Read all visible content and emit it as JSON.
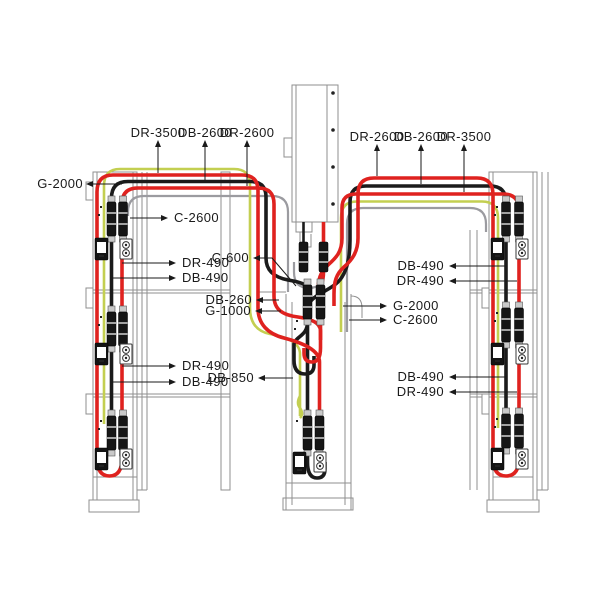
{
  "colors": {
    "red": "#df221f",
    "black": "#1b1b1b",
    "green": "#c3cf51",
    "gray": "#9b9ba0",
    "frame": "#8f8f8f",
    "leader": "#1a1a1a"
  },
  "labels": {
    "top_left": [
      "DR-3500",
      "DB-2600",
      "DR-2600"
    ],
    "top_right": [
      "DR-2600",
      "DB-2600",
      "DR-3500"
    ],
    "g2000_left": "G-2000",
    "c2600_left": "C-2600",
    "dr490_upper_left": "DR-490",
    "db490_upper_left": "DB-490",
    "dr490_lower_left": "DR-490",
    "db490_lower_left": "DB-490",
    "c600": "C-600",
    "db260": "DB-260",
    "g1000": "G-1000",
    "g2000_center": "G-2000",
    "c2600_center": "C-2600",
    "db850": "DB-850",
    "db490_upper_right": "DB-490",
    "dr490_upper_right": "DR-490",
    "db490_lower_right": "DB-490",
    "dr490_lower_right": "DR-490"
  }
}
